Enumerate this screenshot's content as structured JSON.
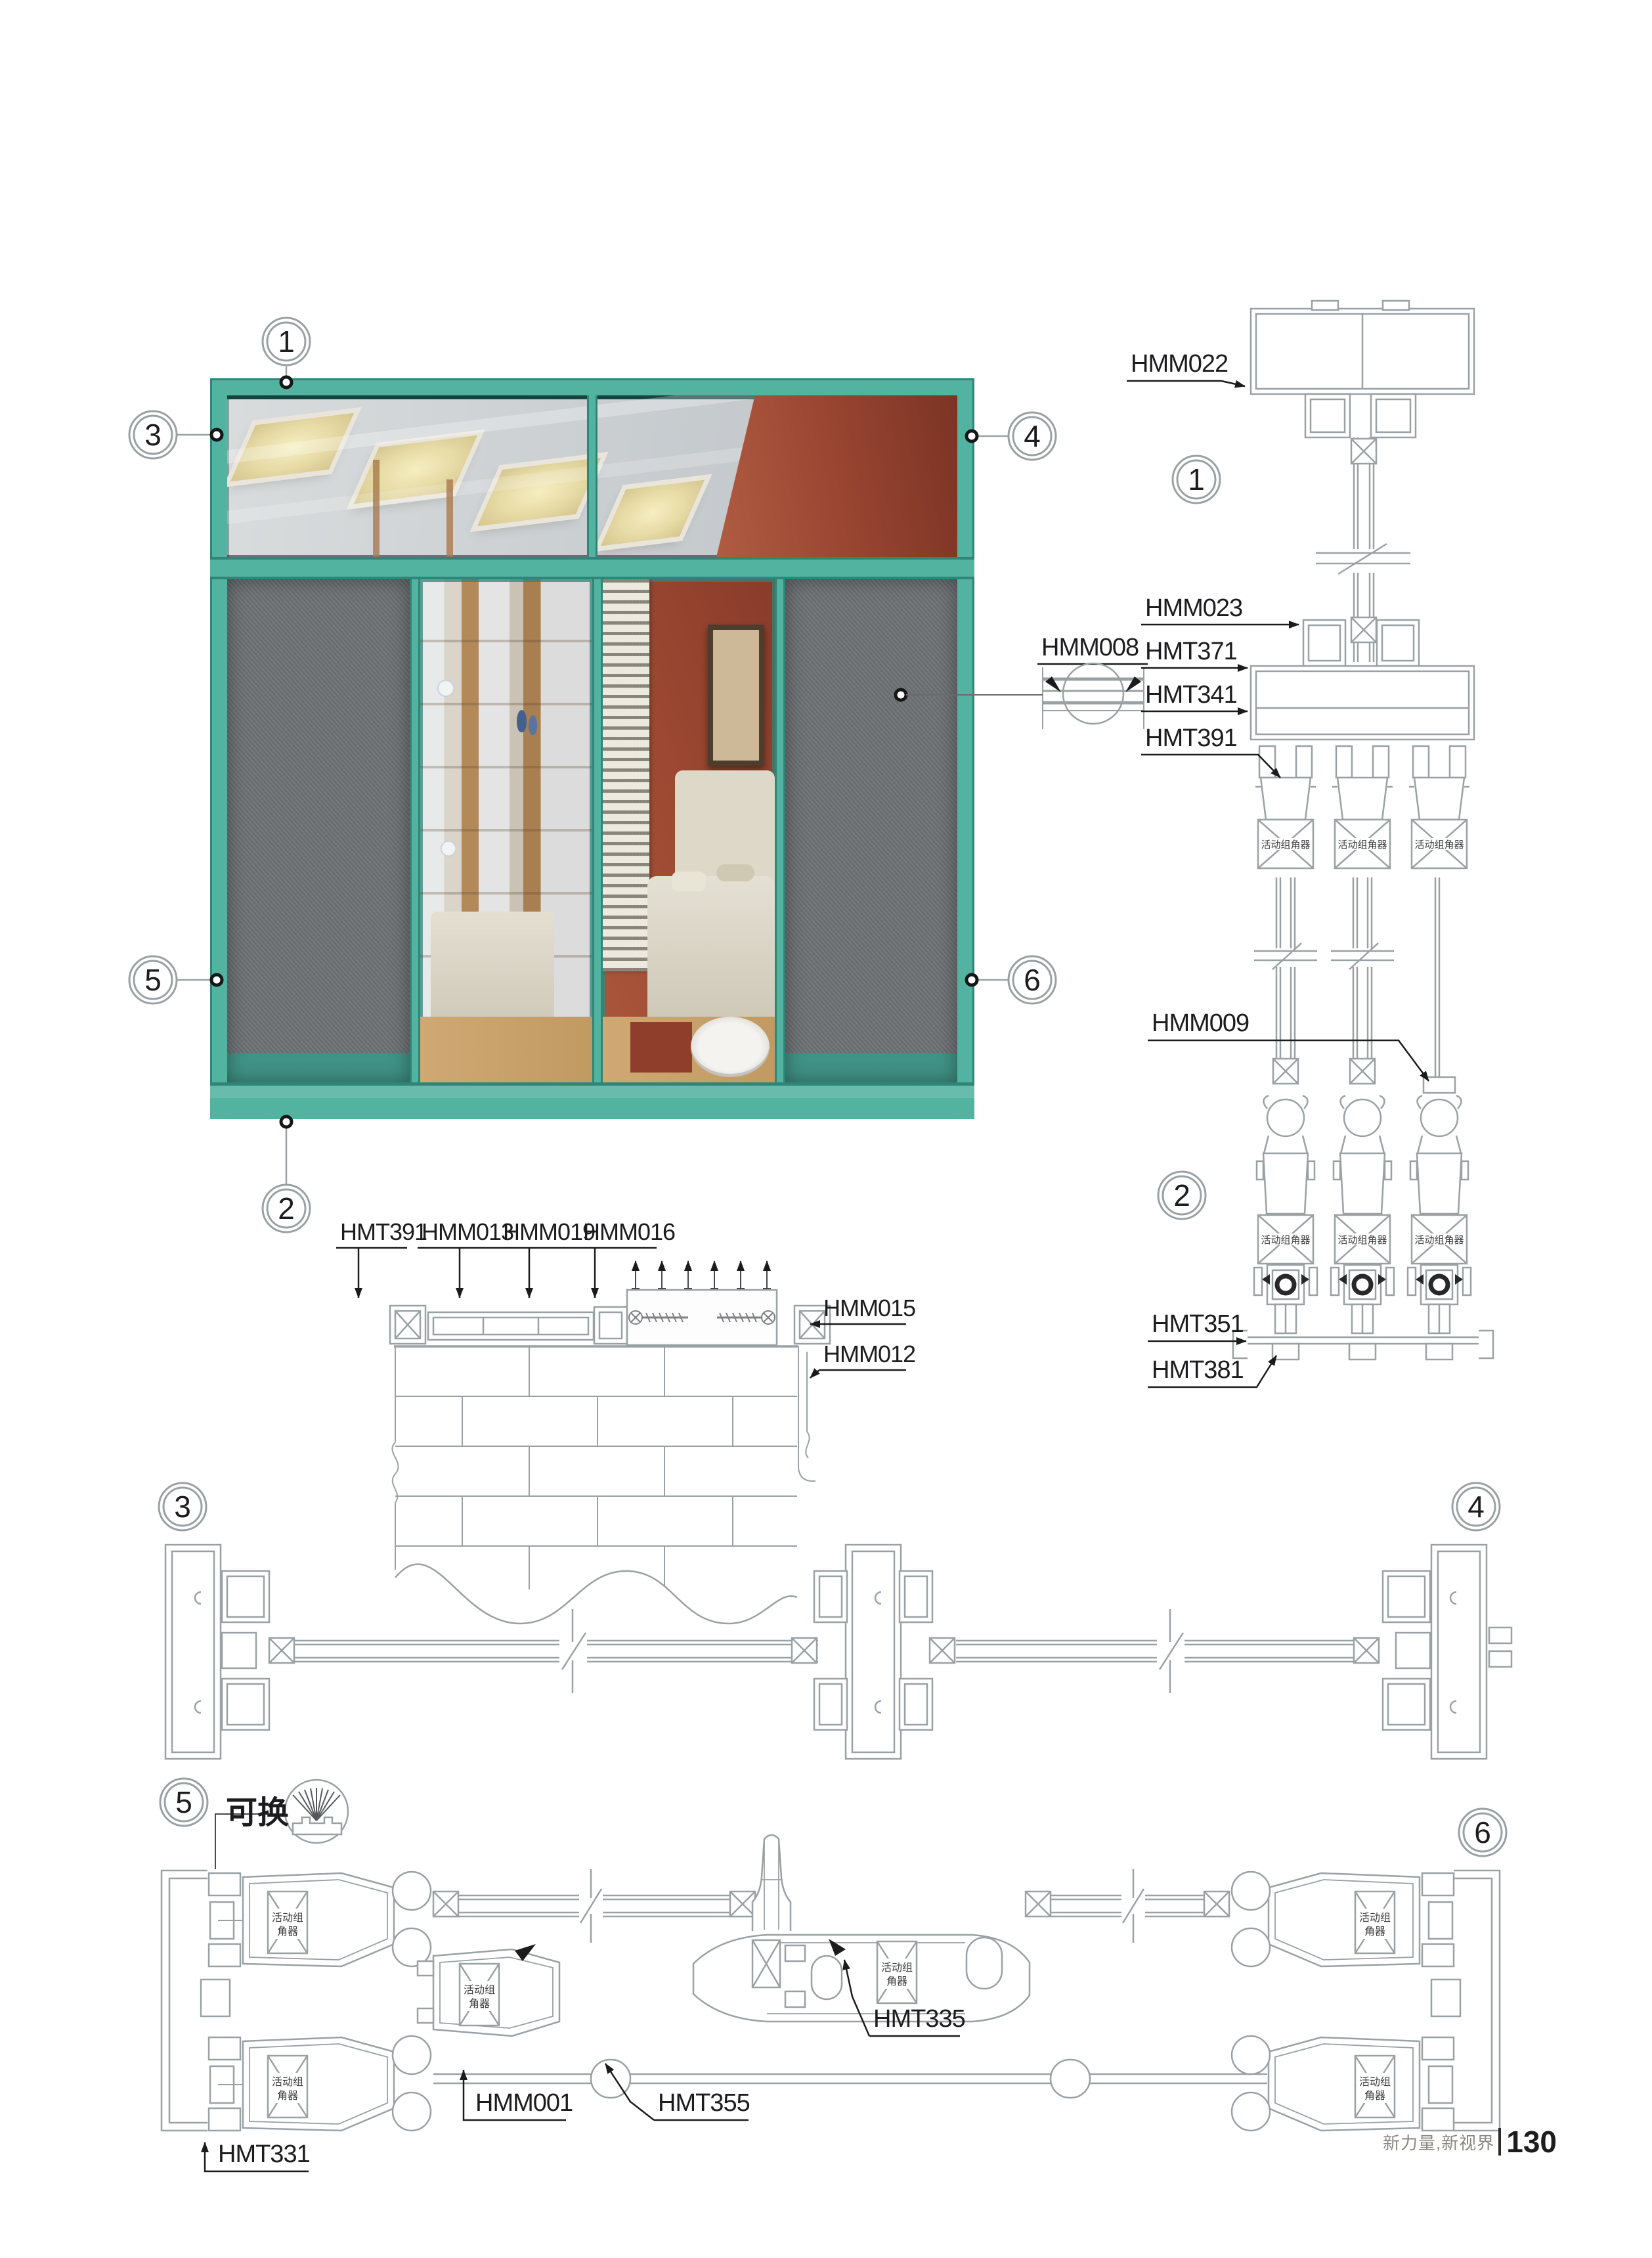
{
  "page": {
    "footer_brand": "新力量,新视界",
    "footer_page": "130"
  },
  "colors": {
    "frame_teal": "#52b3a0",
    "frame_teal_dark": "#2f8577",
    "line_gray": "#9aa1a4",
    "text": "#1c1c1e",
    "screen_gray": "#6f7376",
    "red_wall": "#9c4733"
  },
  "elevation": {
    "callout_1": "1",
    "callout_2": "2",
    "callout_3": "3",
    "callout_4": "4",
    "callout_5": "5",
    "callout_6": "6",
    "hmm008_label": "HMM008"
  },
  "vertical_section": {
    "callout_top": "1",
    "callout_bottom": "2",
    "hmm022": "HMM022",
    "hmm023": "HMM023",
    "hmt371": "HMT371",
    "hmt341": "HMT341",
    "hmt391": "HMT391",
    "hmm009": "HMM009",
    "hmt351": "HMT351",
    "hmt381": "HMT381",
    "corner_connector": "活动组角器"
  },
  "sill_section": {
    "hmt391": "HMT391",
    "hmm013": "HMM013",
    "hmm019": "HMM019",
    "hmm016": "HMM016",
    "hmm015": "HMM015",
    "hmm012": "HMM012"
  },
  "section_34": {
    "callout_left": "3",
    "callout_right": "4"
  },
  "section_56": {
    "callout_left": "5",
    "callout_right": "6",
    "swap_label": "可换",
    "hmt331": "HMT331",
    "hmm001": "HMM001",
    "hmt355": "HMT355",
    "hmt335": "HMT335",
    "corner_line1": "活动组",
    "corner_line2": "角器"
  }
}
